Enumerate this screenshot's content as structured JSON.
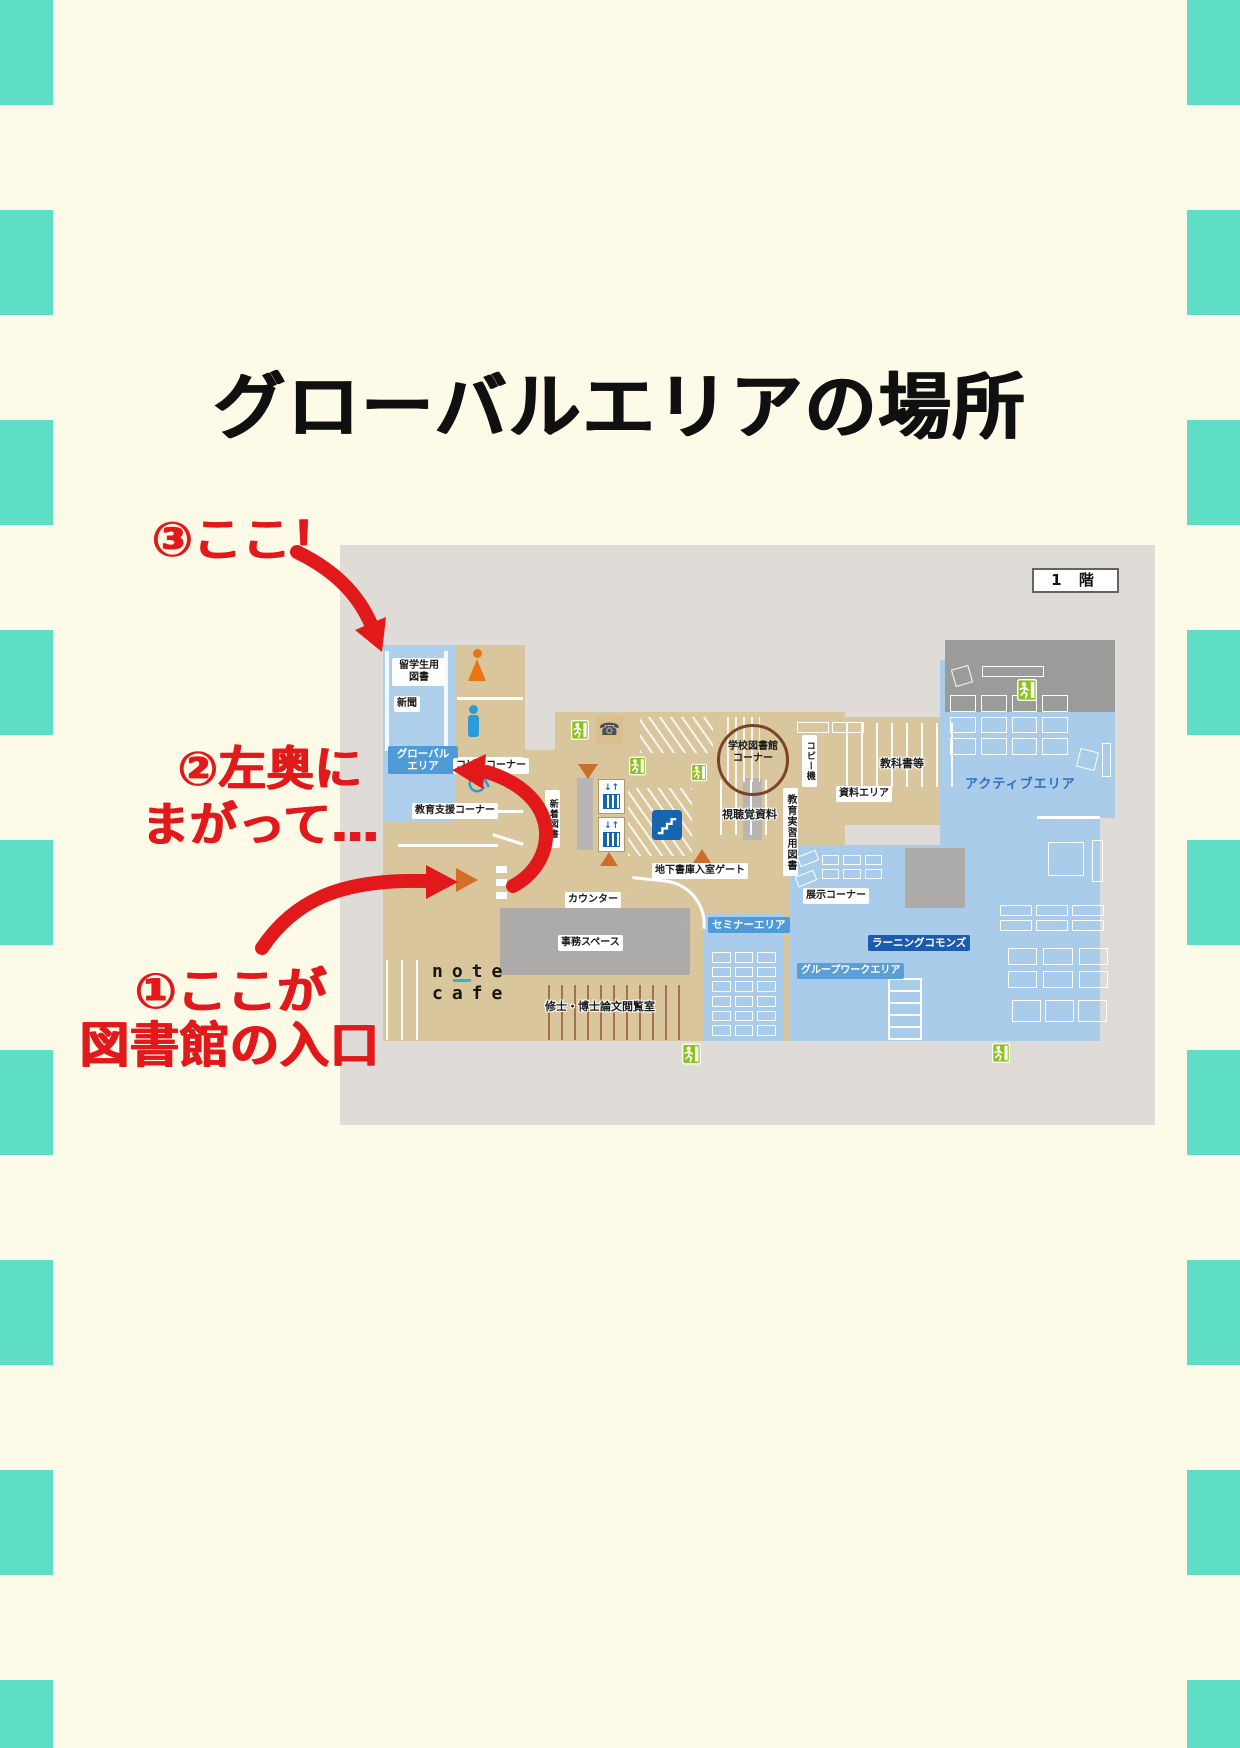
{
  "title": "グローバルエリアの場所",
  "annotations": {
    "step3": "③ここ！",
    "step2_line1": "②左奥に",
    "step2_line2": "まがって…",
    "step1_line1": "①ここが",
    "step1_line2": "図書館の入口"
  },
  "map": {
    "floor_tag": "1 階",
    "labels": {
      "ryugakusei": "留学生用\n図書",
      "shinbun": "新聞",
      "global_area": "グローバル\nエリア",
      "copy_corner": "コピーコーナー",
      "kyoiku_shien": "教育支援コーナー",
      "shincho_tosho": "新着図書",
      "school_library": "学校図書館\nコーナー",
      "copy_machine": "コピー機",
      "kyokasho": "教科書等",
      "shiryo_area": "資料エリア",
      "kyoiku_jisshu": "教育実習用図書",
      "shichokaku": "視聴覚資料",
      "active_area": "アクティブエリア",
      "chika_gate": "地下書庫入室ゲート",
      "counter": "カウンター",
      "jimu_space": "事務スペース",
      "note_cafe_line1": "note",
      "note_cafe_line2": "cafe",
      "ronbun_room": "修士・博士論文閲覧室",
      "seminar_area": "セミナーエリア",
      "learning_commons": "ラーニングコモンズ",
      "groupwork_area": "グループワークエリア",
      "tenji_corner": "展示コーナー"
    },
    "icons": [
      "exit-sign-icon",
      "phone-icon",
      "elevator-icon",
      "stairs-icon",
      "woman-toilet-icon",
      "man-toilet-icon",
      "wheelchair-icon",
      "entrance-triangle-icon"
    ]
  },
  "colors": {
    "border_teal": "#5EDEC5",
    "background_cream": "#FDFBE8",
    "annotation_red": "#E2191B",
    "map_background": "#DFDBD7",
    "floor_tan": "#DAC69C",
    "area_blue": "#A8CCEA",
    "badge_blue": "#4E9BD8",
    "commons_badge_blue": "#1D5CAC",
    "dark_gray": "#9B9B99",
    "exit_green": "#8CC21E",
    "icon_blue": "#1565B0",
    "entrance_orange": "#D2702A"
  }
}
